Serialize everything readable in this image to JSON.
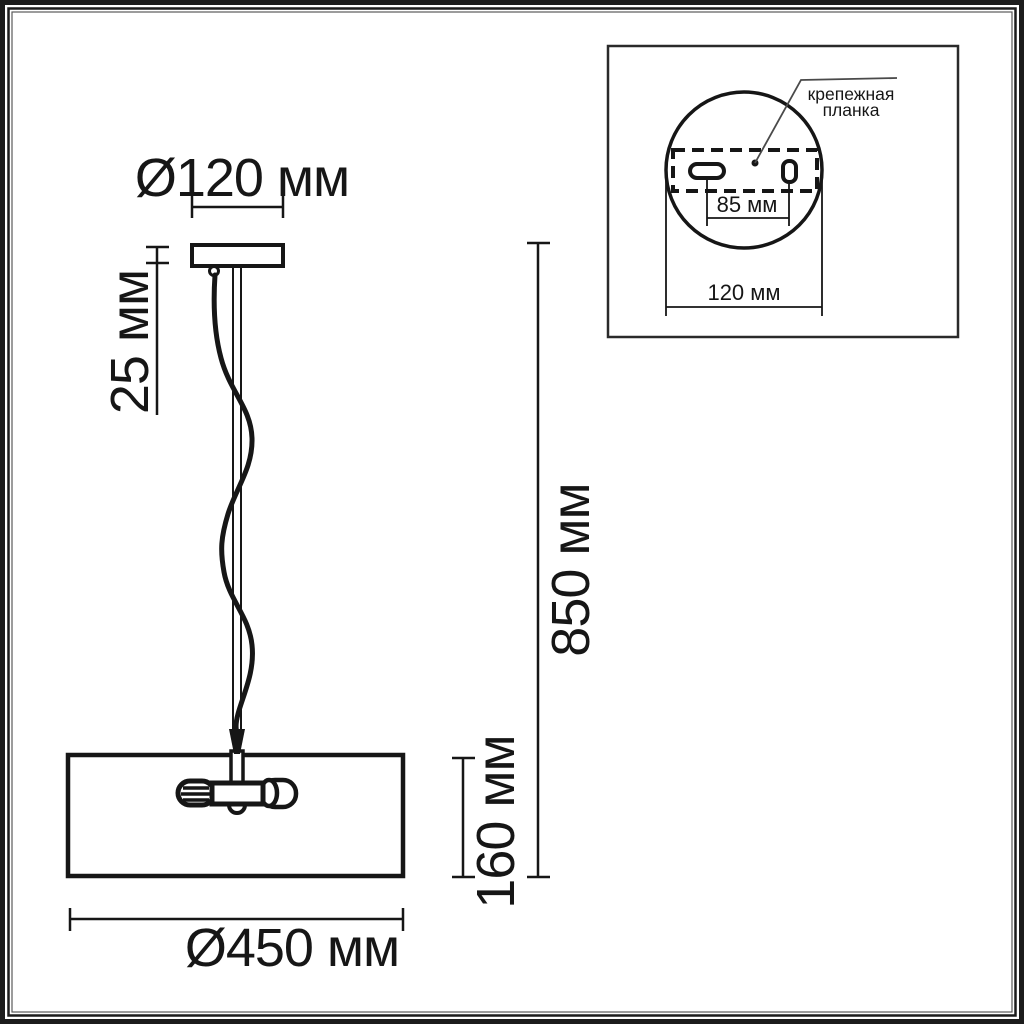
{
  "drawing": {
    "type": "pendant-lamp-dimensional-diagram",
    "colors": {
      "ink": "#161616",
      "background": "#ffffff"
    },
    "dimensions": {
      "canopy_diameter": "Ø120 мм",
      "canopy_height": "25 мм",
      "overall_height": "850 мм",
      "shade_height": "160 мм",
      "shade_diameter": "Ø450 мм"
    }
  },
  "inset": {
    "callout_line1": "крепежная",
    "callout_line2": "планка",
    "hole_spacing": "85 мм",
    "plate_diameter": "120 мм"
  }
}
